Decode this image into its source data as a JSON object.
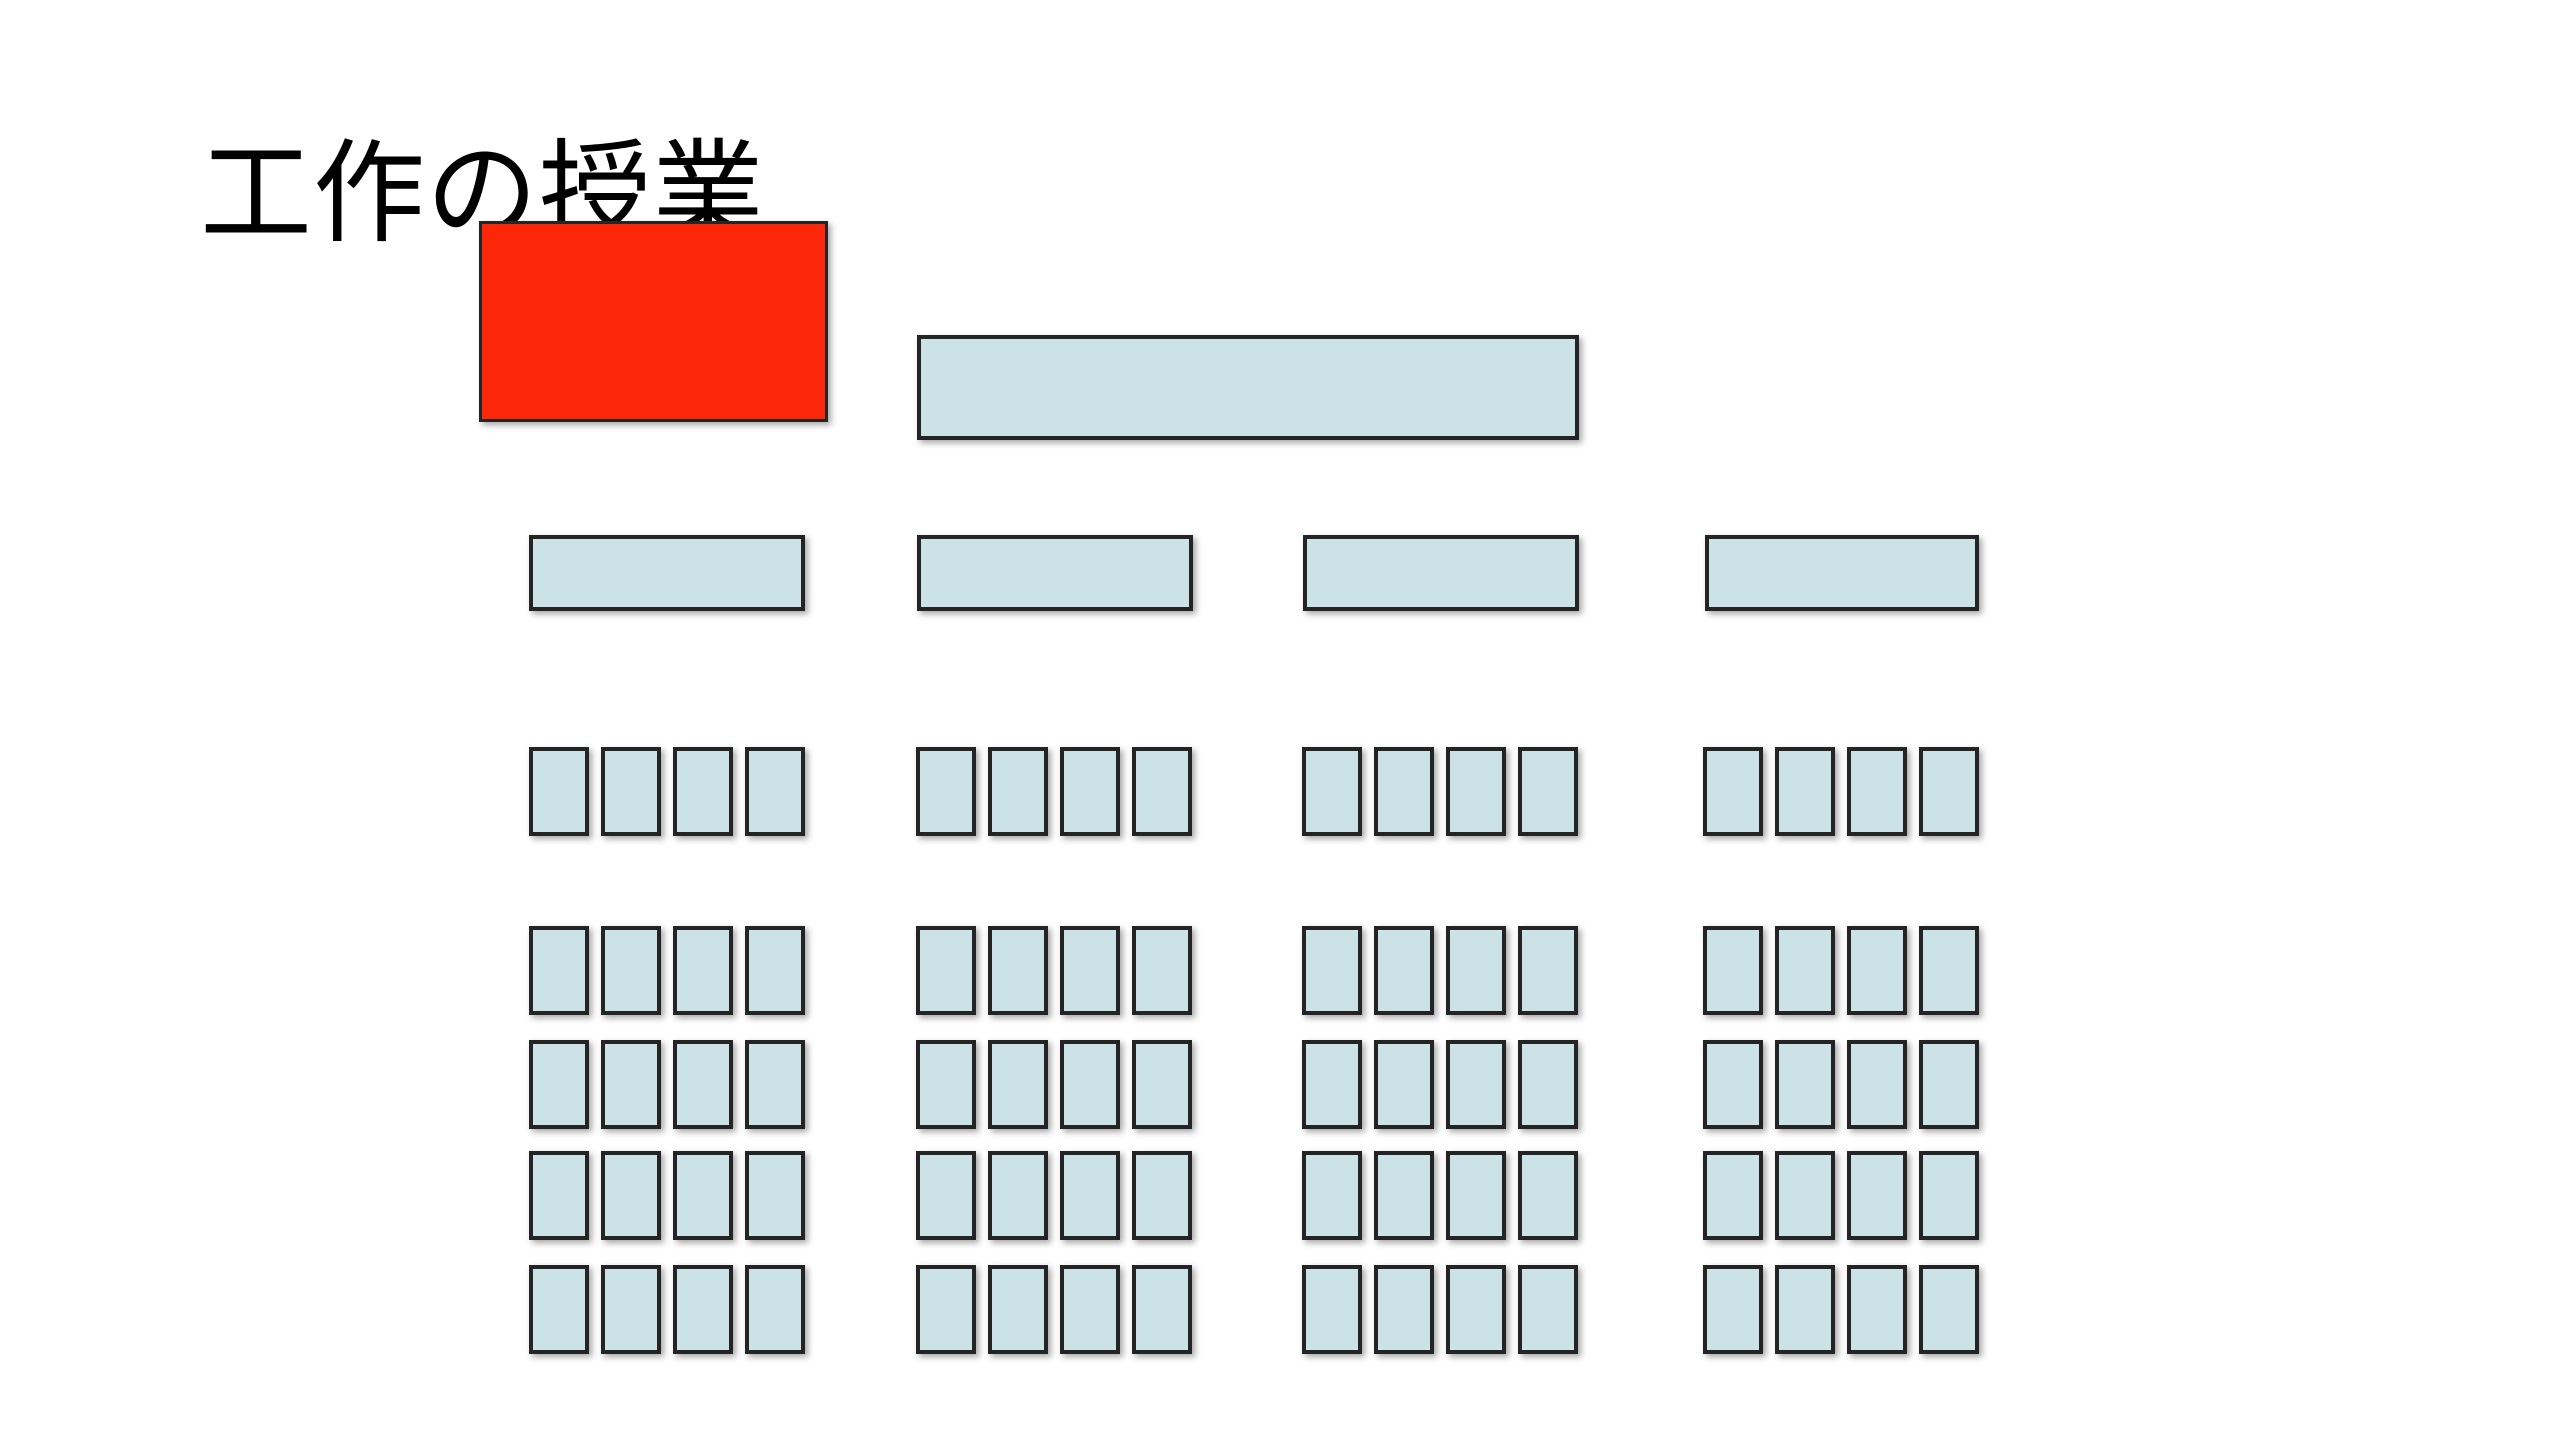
{
  "slide": {
    "title": "工作の授業",
    "background_color": "#ffffff"
  },
  "colors": {
    "seat_fill": "#cbe3e7",
    "outline": "#242424",
    "highlight_fill": "#fb2708",
    "title_color": "#000000"
  },
  "diagram": {
    "type": "classroom_seating_plan",
    "highlight_block": {
      "color_hex": "#fb2708",
      "overlaps_title": true
    },
    "teacher_desk_count": 1,
    "table_count": 4,
    "seat_groups": [
      {
        "name": "group-1",
        "front_row_seats": 4,
        "grid_rows": 4,
        "grid_cols": 4,
        "total_seats": 20
      },
      {
        "name": "group-2",
        "front_row_seats": 4,
        "grid_rows": 4,
        "grid_cols": 4,
        "total_seats": 20
      },
      {
        "name": "group-3",
        "front_row_seats": 4,
        "grid_rows": 4,
        "grid_cols": 4,
        "total_seats": 20
      },
      {
        "name": "group-4",
        "front_row_seats": 4,
        "grid_rows": 4,
        "grid_cols": 4,
        "total_seats": 20
      }
    ],
    "total_seats": 80
  }
}
